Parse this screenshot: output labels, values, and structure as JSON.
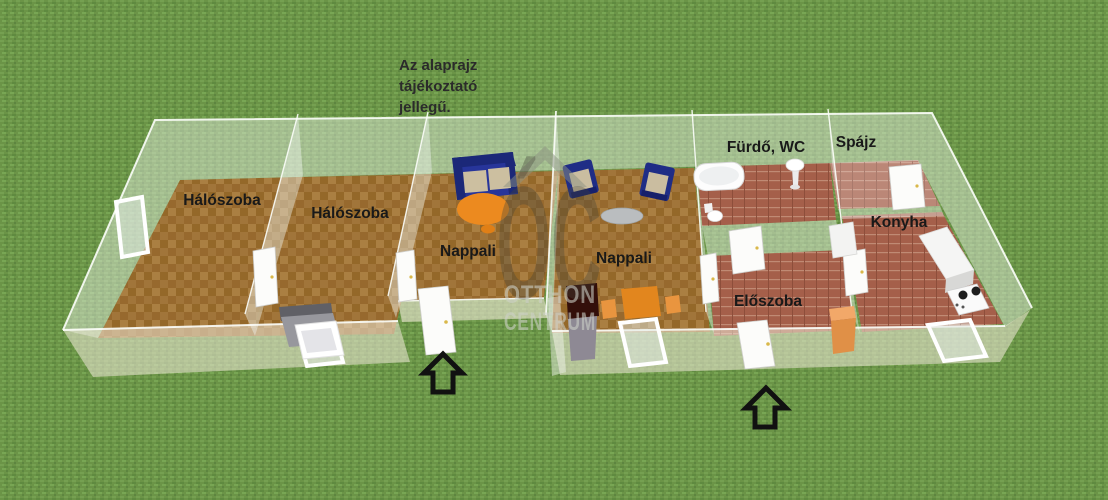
{
  "page": {
    "disclaimer": {
      "lines": [
        "Az alaprajz",
        "tájékoztató",
        "jellegű."
      ]
    },
    "watermark": {
      "monogram": "ÓC",
      "name_line1": "OTTHON",
      "name_line2": "CENTRUM"
    },
    "rooms": {
      "bedroom1": "Hálószoba",
      "bedroom2": "Hálószoba",
      "living1": "Nappali",
      "living2": "Nappali",
      "bathroom": "Fürdő, WC",
      "pantry": "Spájz",
      "kitchen": "Konyha",
      "hallway": "Előszoba"
    },
    "colors": {
      "grass": "#6b9447",
      "wood_floor": "#a1753a",
      "tile_floor": "#a55f4a",
      "wall_translucent": "rgba(244,247,242,0.42)",
      "sofa_navy": "#27359a",
      "cushion_beige": "#ccbfa0",
      "table_orange": "#ec8a1f",
      "label_text": "#191919",
      "arrow_black": "#111111",
      "watermark_gray": "#8c9184"
    }
  }
}
